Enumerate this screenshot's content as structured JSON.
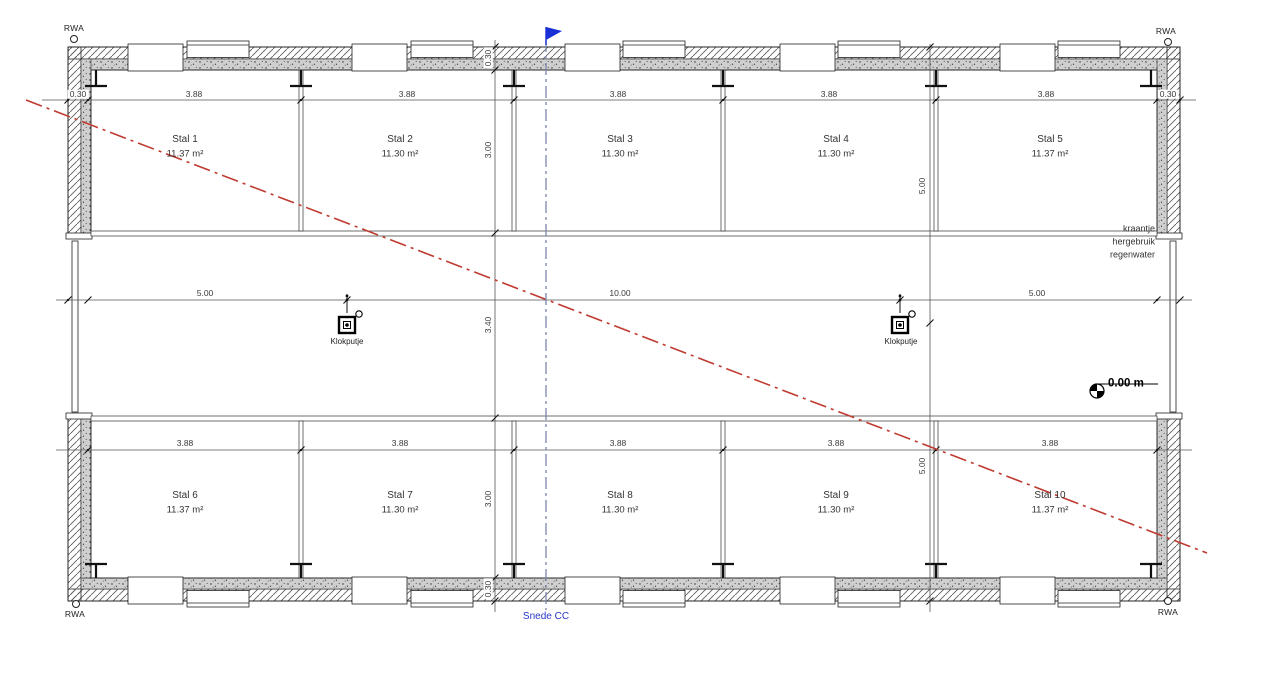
{
  "drawing": {
    "rwa_label": "RWA",
    "stalls": [
      {
        "name": "Stal 1",
        "area": "11.37 m²"
      },
      {
        "name": "Stal 2",
        "area": "11.30 m²"
      },
      {
        "name": "Stal 3",
        "area": "11.30 m²"
      },
      {
        "name": "Stal 4",
        "area": "11.30 m²"
      },
      {
        "name": "Stal 5",
        "area": "11.37 m²"
      },
      {
        "name": "Stal 6",
        "area": "11.37 m²"
      },
      {
        "name": "Stal 7",
        "area": "11.30 m²"
      },
      {
        "name": "Stal 8",
        "area": "11.30 m²"
      },
      {
        "name": "Stal 9",
        "area": "11.30 m²"
      },
      {
        "name": "Stal 10",
        "area": "11.37 m²"
      }
    ],
    "dims": {
      "top": [
        "0.30",
        "3.88",
        "3.88",
        "3.88",
        "3.88",
        "3.88",
        "0.30"
      ],
      "bottom": [
        "3.88",
        "3.88",
        "3.88",
        "3.88",
        "3.88"
      ],
      "corridor": [
        "5.00",
        "10.00",
        "5.00"
      ],
      "left_vertical": [
        "0.30",
        "3.00",
        "3.40",
        "3.00",
        "0.30"
      ],
      "right_vertical": [
        "5.00",
        "5.00"
      ]
    },
    "annotations": {
      "klokputje": "Klokputje",
      "level": "0.00 m",
      "tap_note": [
        "kraantje",
        "hergebruik",
        "regenwater"
      ],
      "section_label": "Snede CC"
    },
    "colors": {
      "section_cut_red": "#bf3a30",
      "section_line_blue": "#7b87ad",
      "flag_blue": "#1b2fd6",
      "section_text_blue": "#2936c8",
      "linework": "#333333"
    }
  }
}
